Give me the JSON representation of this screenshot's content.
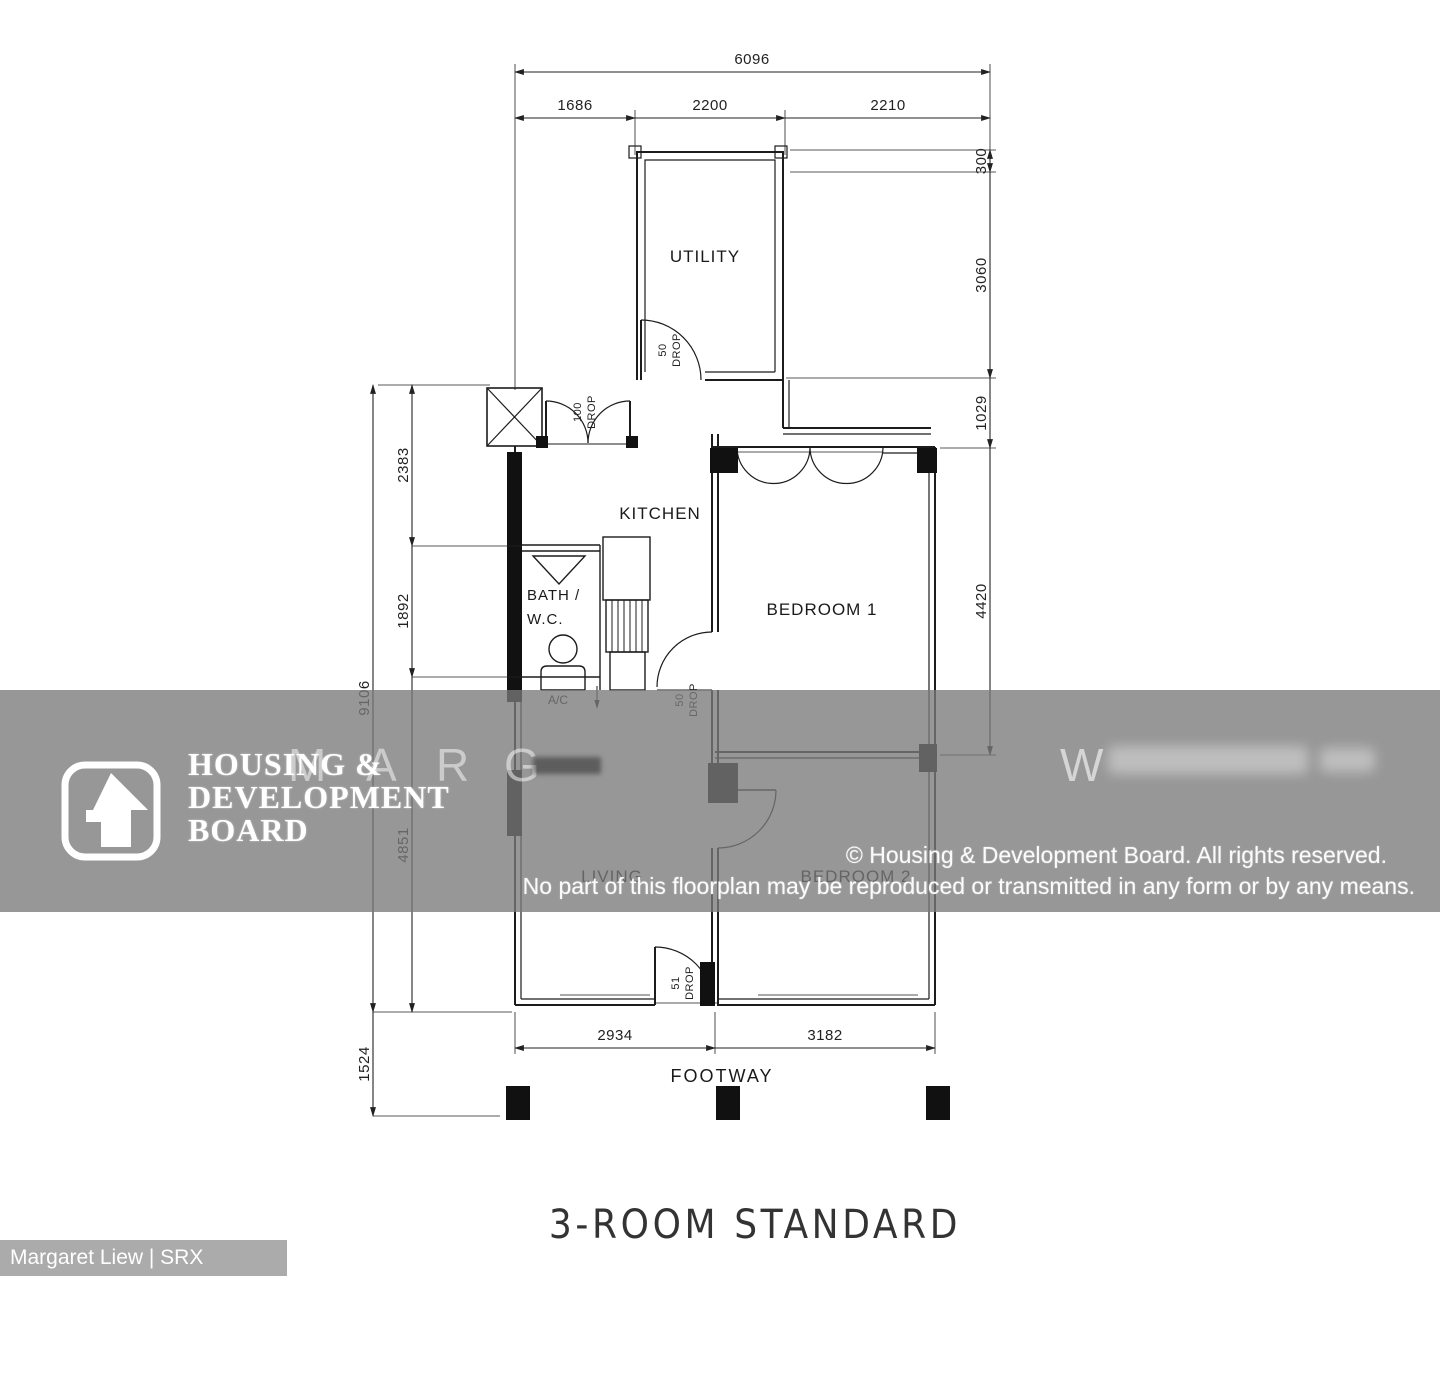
{
  "title": "3-ROOM STANDARD",
  "credit": "Margaret Liew | SRX PROPERTY",
  "rooms": {
    "utility": "UTILITY",
    "kitchen": "KITCHEN",
    "bath_line1": "BATH /",
    "bath_line2": "W.C.",
    "bedroom1": "BEDROOM 1",
    "living": "LIVING",
    "bedroom2": "BEDROOM 2",
    "footway": "FOOTWAY",
    "ac_ledge": "A/C"
  },
  "dimensions": {
    "overall_width": "6096",
    "top_segments": [
      "1686",
      "2200",
      "2210"
    ],
    "right_side": [
      "300",
      "3060",
      "1029",
      "4420"
    ],
    "left_inner": [
      "2383",
      "1892",
      "4851"
    ],
    "left_overall": "9106",
    "bottom_left": "1524",
    "bottom_segments": [
      "2934",
      "3182"
    ]
  },
  "drops": {
    "label": "DROP",
    "entrance_value": "100",
    "utility_value": "50",
    "kitchen_value": "50",
    "footway_value": "51"
  },
  "watermark": {
    "org_line1": "HOUSING &",
    "org_line2": "DEVELOPMENT",
    "org_line3": "BOARD",
    "faint_letters": [
      "M",
      "A",
      "R",
      "G"
    ],
    "faint_right": "W",
    "copyright_line1": "© Housing & Development Board. All rights reserved.",
    "copyright_line2": "No part of this floorplan may be reproduced or transmitted in any form or by any means."
  },
  "colors": {
    "line": "#1c1c1c",
    "dim_line": "#222222",
    "band": "rgba(122,122,122,0.78)",
    "ribbon": "#ababab"
  }
}
